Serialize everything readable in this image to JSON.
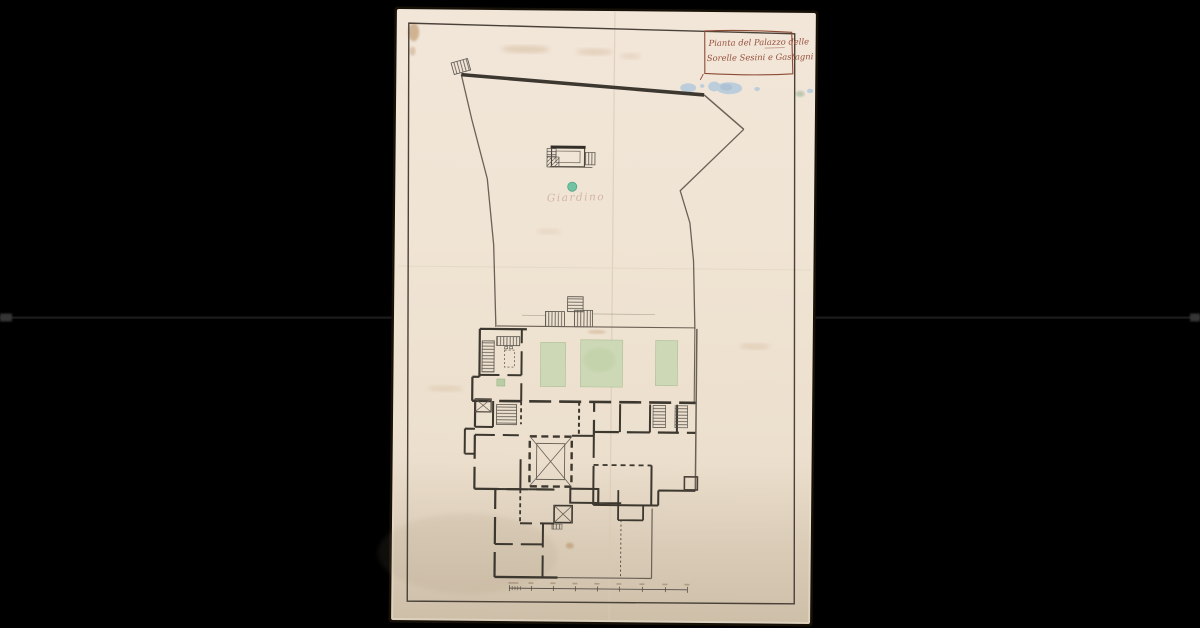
{
  "colors": {
    "background": "#000000",
    "seam": "#1c1c1c",
    "seam_glow": "#343434",
    "paper": "#efe3d3",
    "paper_top": "#f2e6d9",
    "paper_bottom": "#ddd1bd",
    "paper_shadow": "#171108",
    "frame_ink": "#4a4239",
    "ink": "#6a6157",
    "wall": "#3c372f",
    "rung": "#57514a",
    "script_ink": "#96513c",
    "cartouche_ink": "#8d4a35",
    "green_wash": "#ccd8b6",
    "green_edge": "#b4c29c",
    "green_dot": "#72c3a1",
    "blue_wash": "#b3c9dc",
    "stain_brown": "#a8763f",
    "wash_bottom": "#a99578"
  },
  "artwork": {
    "cartouche": {
      "line1": "Pianta del Palazzo delle",
      "line2": "Sorelle Sesini e Gastagni"
    },
    "garden_label": "Giardino"
  }
}
